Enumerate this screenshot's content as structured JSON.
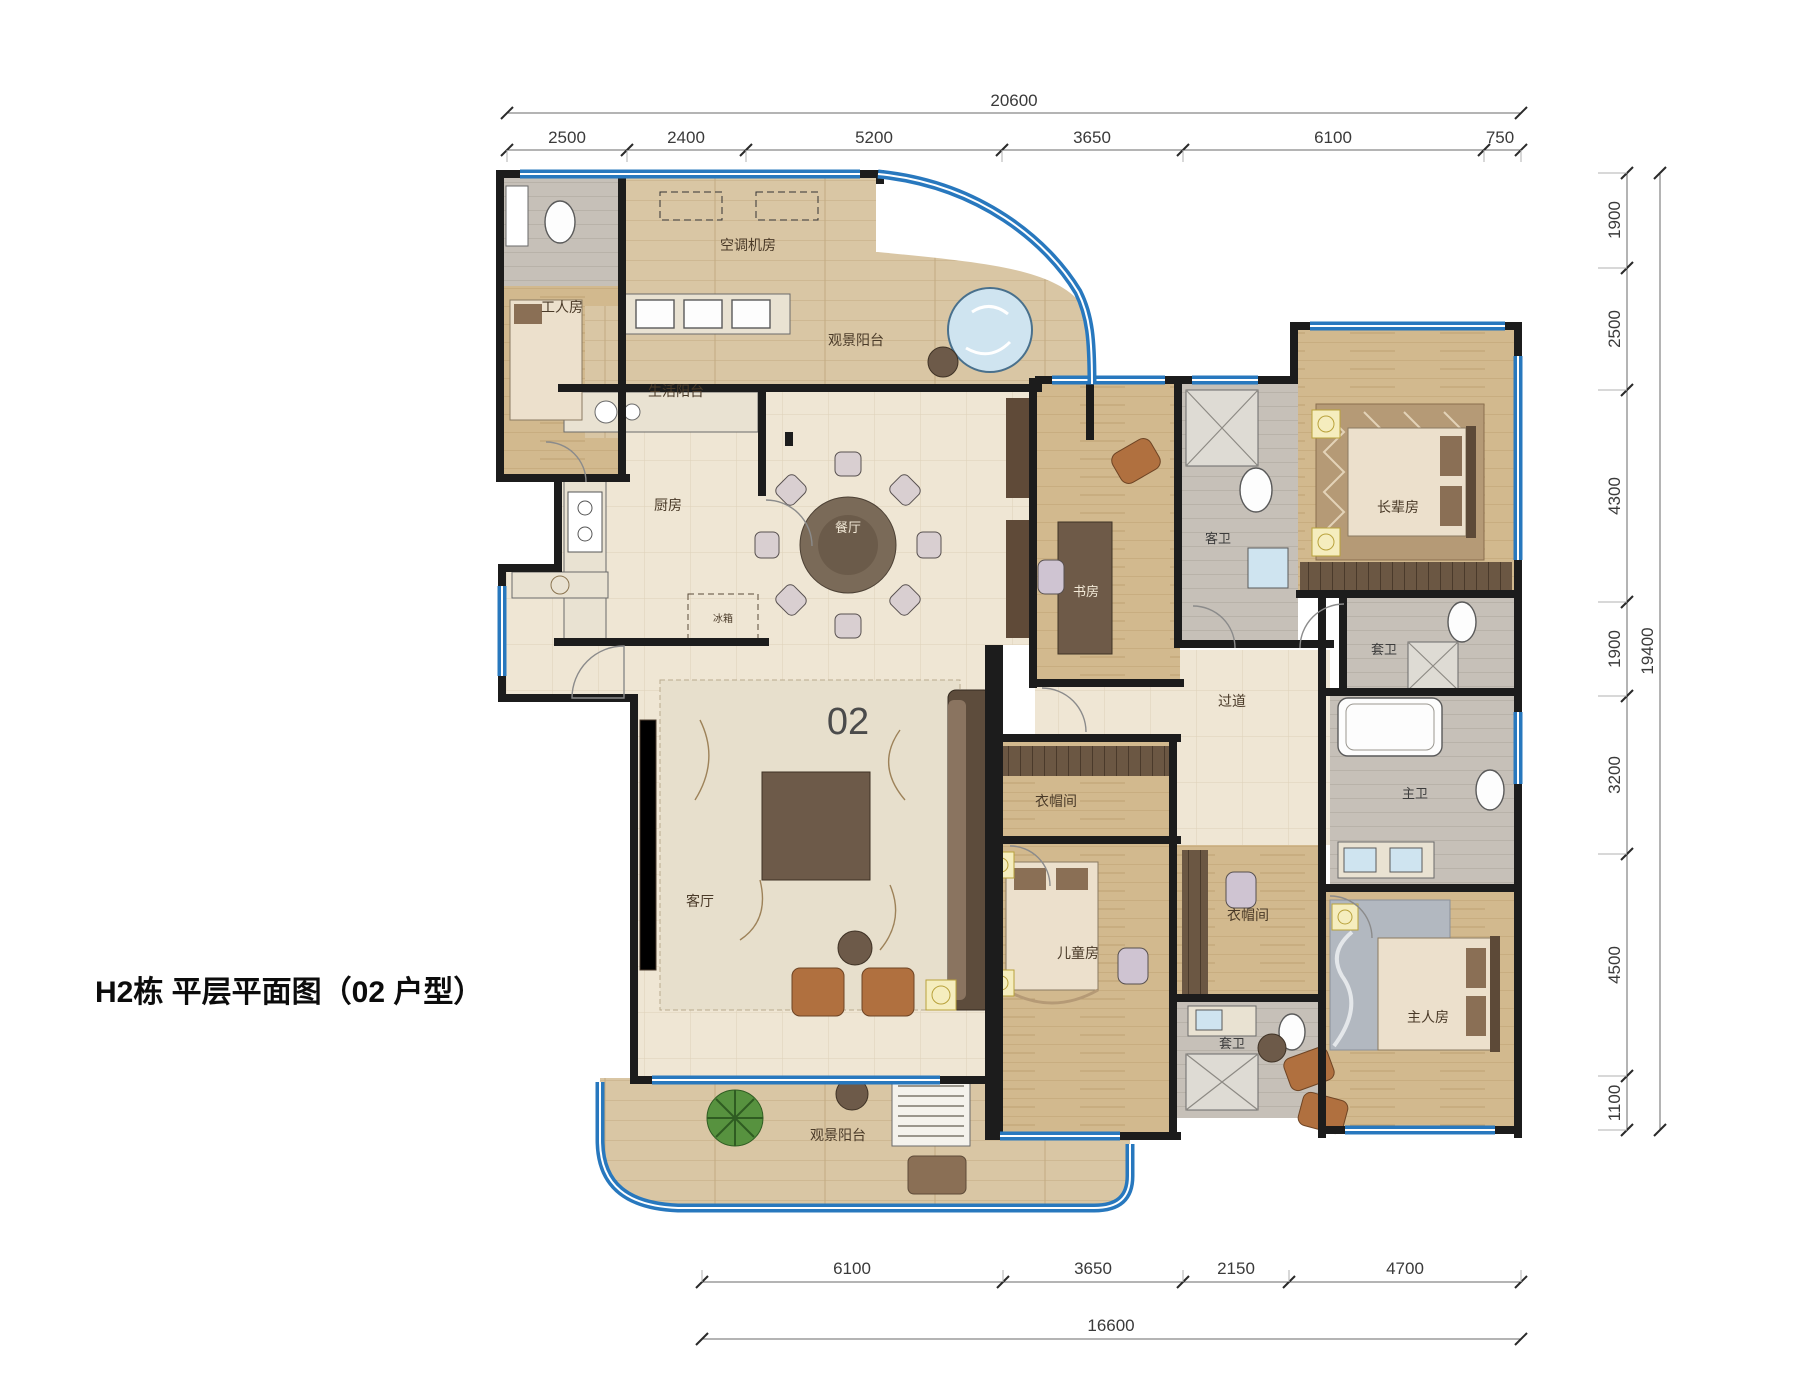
{
  "title": "H2栋 平层平面图（02 户型）",
  "unit_number": "02",
  "dimensions": {
    "top": {
      "total": "20600",
      "segments": [
        "2500",
        "2400",
        "5200",
        "3650",
        "6100",
        "750"
      ]
    },
    "right": {
      "total": "19400",
      "segments": [
        "1900",
        "2500",
        "4300",
        "1900",
        "3200",
        "4500",
        "1100"
      ]
    },
    "bottom": {
      "total": "16600",
      "segments": [
        "6100",
        "3650",
        "2150",
        "4700"
      ]
    }
  },
  "rooms": {
    "worker_room": "工人房",
    "ac_plant_room": "空调机房",
    "service_balcony": "生活阳台",
    "view_balcony_top": "观景阳台",
    "kitchen": "厨房",
    "fridge": "冰箱",
    "dining_room": "餐厅",
    "study": "书房",
    "guest_bath": "客卫",
    "elder_room": "长辈房",
    "ensuite_bath_elder": "套卫",
    "corridor": "过道",
    "living_room": "客厅",
    "cloakroom_north": "衣帽间",
    "kids_room": "儿童房",
    "master_bath": "主卫",
    "cloakroom_south": "衣帽间",
    "ensuite_bath_kids": "套卫",
    "master_room": "主人房",
    "view_balcony_bottom": "观景阳台"
  },
  "colors": {
    "wall": "#1c1c1c",
    "window_blue": "#2878be",
    "tile_floor": "#efe6d4",
    "wood_floor": "#d2b98e",
    "balcony_wood": "#d9c6a4",
    "bath_floor": "#c6c0b8",
    "accent_gold": "#f5edbe"
  }
}
